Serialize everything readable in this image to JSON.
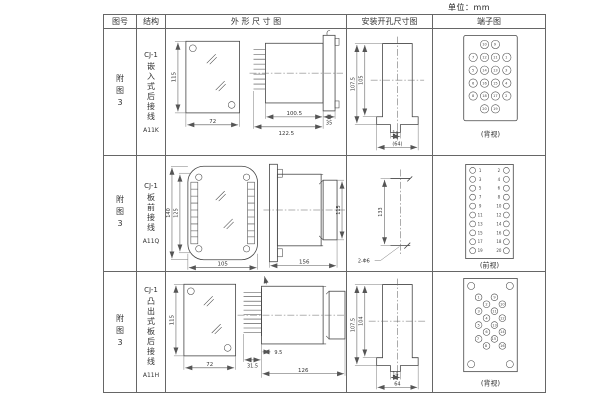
{
  "unit_label": "单位：mm",
  "headers": {
    "fig_no": "图号",
    "structure": "结构",
    "outline": "外 形 尺 寸 图",
    "install": "安装开孔尺寸图",
    "terminal": "端子图"
  },
  "rows": [
    {
      "fig_no": "附图3",
      "model": "CJ-1",
      "structure": "嵌入式后接线",
      "code": "A11K",
      "dims": {
        "front_h": "115",
        "front_w": "72",
        "body_len": "100.5",
        "flange": "35",
        "total": "122.5"
      },
      "install": {
        "outer_h": "107.5",
        "inner_h": "105",
        "slot_w": "14",
        "total_w": "(64)"
      },
      "terminal_view": "(背视)"
    },
    {
      "fig_no": "附图3",
      "model": "CJ-1",
      "structure": "板前接线",
      "code": "A11Q",
      "dims": {
        "front_outer_h": "140",
        "front_inner_h": "125",
        "front_w": "105",
        "side_len": "156",
        "side_h": "115"
      },
      "install": {
        "spacing": "133",
        "holes": "2-Φ6"
      },
      "terminal_view": "(前视)"
    },
    {
      "fig_no": "附图3",
      "model": "CJ-1",
      "structure": "凸出式板后接线",
      "code": "A11H",
      "dims": {
        "front_h": "115",
        "front_w": "72",
        "pin_len": "31.5",
        "offset": "9.5",
        "body_len": "126"
      },
      "install": {
        "outer_h": "107.5",
        "inner_h": "104",
        "slot_w": "14",
        "total_w": "64"
      },
      "terminal_view": "(背视)"
    }
  ],
  "terminals": {
    "r1": [
      "10",
      "9",
      "7",
      "12",
      "11",
      "1",
      "5",
      "14",
      "13",
      "3",
      "6",
      "16",
      "15",
      "4",
      "8",
      "18",
      "17",
      "2",
      "20",
      "19"
    ],
    "r2_left": [
      "1",
      "3",
      "5",
      "7",
      "9",
      "11",
      "13",
      "15",
      "17",
      "19"
    ],
    "r2_right": [
      "2",
      "4",
      "6",
      "8",
      "10",
      "12",
      "14",
      "16",
      "18",
      "20"
    ],
    "r3": [
      "1",
      "3",
      "5",
      "7",
      "2",
      "4",
      "6",
      "8",
      "9",
      "11",
      "13",
      "15",
      "10",
      "12",
      "14",
      "16"
    ]
  }
}
